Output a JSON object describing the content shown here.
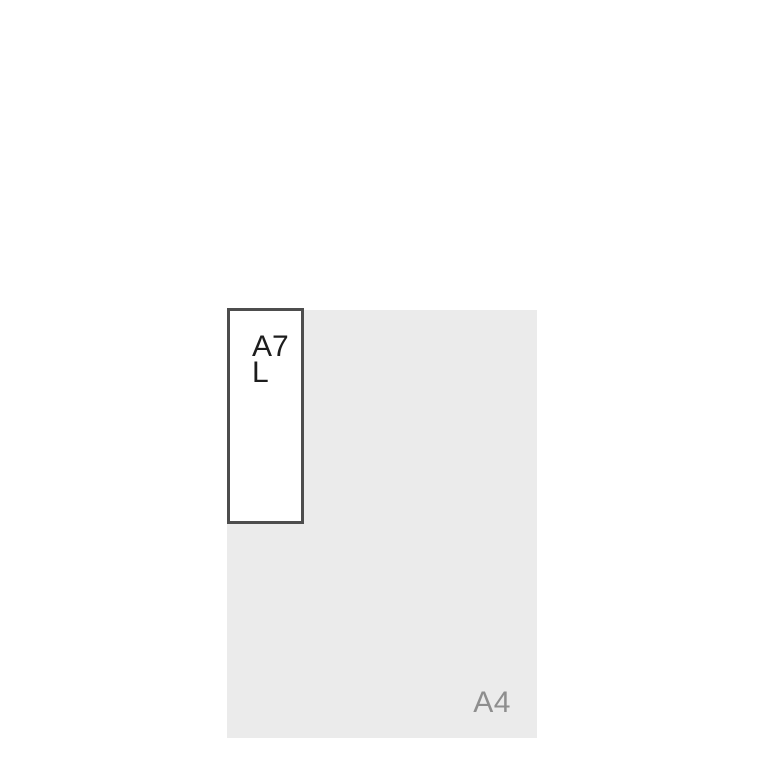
{
  "page": {
    "background_color": "#ffffff"
  },
  "comparison": {
    "base_sheet": {
      "label": "A4",
      "fill_color": "#ebebeb",
      "label_color": "#8e8e8e"
    },
    "overlay_sheet": {
      "label": "A7 L",
      "fill_color": "#ffffff",
      "border_color": "#4d4d4d",
      "label_color": "#1d1d1d"
    }
  }
}
